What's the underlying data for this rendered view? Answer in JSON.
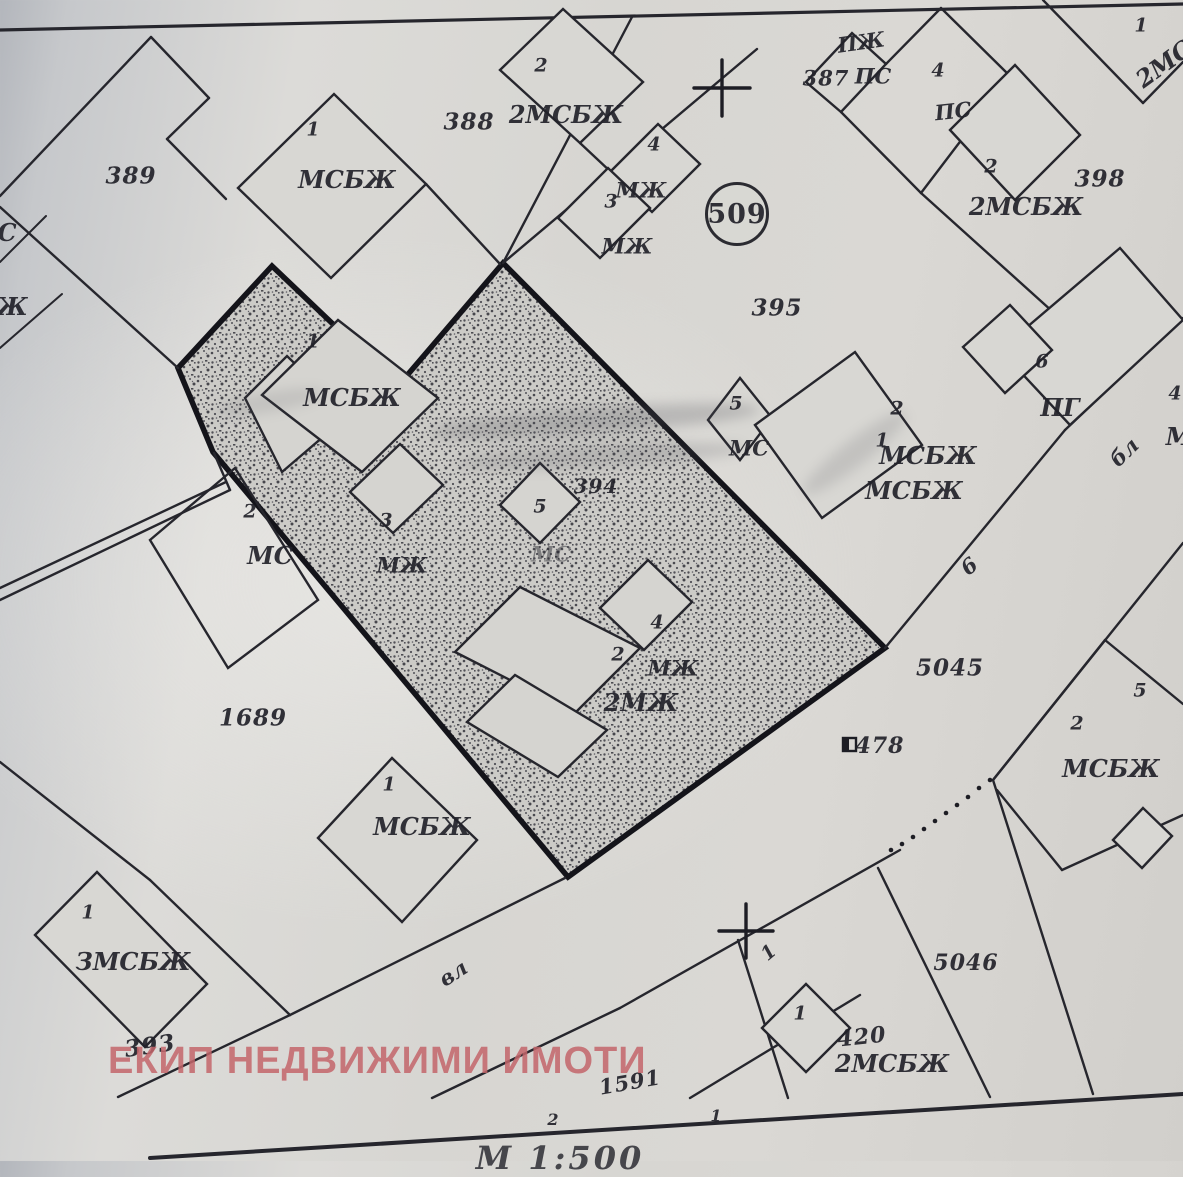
{
  "watermark": {
    "text": "ЕКИП НЕДВИЖИМИ ИМОТИ",
    "color": "#c4666b"
  },
  "colors": {
    "paper": "#d7d6d2",
    "ink": "#26262d",
    "plot_border": "#14141a",
    "watermark_red": "#c4666b"
  },
  "map": {
    "plot_circle_label": "509",
    "scale_note": "М 1:500",
    "labels": [
      {
        "t": "389",
        "x": 131,
        "y": 176,
        "c": "parcel"
      },
      {
        "t": "388",
        "x": 469,
        "y": 122,
        "c": "parcel"
      },
      {
        "t": "387",
        "x": 826,
        "y": 78,
        "c": "parcel",
        "s": 21
      },
      {
        "t": "398",
        "x": 1100,
        "y": 179,
        "c": "parcel"
      },
      {
        "t": "395",
        "x": 777,
        "y": 308,
        "c": "parcel"
      },
      {
        "t": "394",
        "x": 596,
        "y": 486,
        "c": "parcel",
        "s": 20
      },
      {
        "t": "1689",
        "x": 253,
        "y": 718,
        "c": "parcel"
      },
      {
        "t": "393",
        "x": 150,
        "y": 1046,
        "c": "parcel",
        "r": -8
      },
      {
        "t": "5045",
        "x": 950,
        "y": 668,
        "c": "parcel"
      },
      {
        "t": "5046",
        "x": 966,
        "y": 963,
        "c": "parcel",
        "s": 22
      },
      {
        "t": "420",
        "x": 862,
        "y": 1037,
        "c": "parcel",
        "r": -6,
        "s": 22
      },
      {
        "t": "1591",
        "x": 630,
        "y": 1082,
        "c": "parcel",
        "r": -10,
        "s": 21
      },
      {
        "t": "478",
        "x": 880,
        "y": 746,
        "c": "parcel",
        "s": 22
      },
      {
        "t": "МСБЖ",
        "x": 347,
        "y": 180,
        "c": "type"
      },
      {
        "t": "2МСБЖ",
        "x": 566,
        "y": 115,
        "c": "type"
      },
      {
        "t": "МЖ",
        "x": 641,
        "y": 190,
        "c": "type",
        "s": 21
      },
      {
        "t": "МЖ",
        "x": 627,
        "y": 246,
        "c": "type",
        "s": 21
      },
      {
        "t": "ПЖ",
        "x": 861,
        "y": 42,
        "c": "type",
        "s": 21,
        "r": -8
      },
      {
        "t": "ПС",
        "x": 873,
        "y": 76,
        "c": "type",
        "s": 21
      },
      {
        "t": "ПС",
        "x": 953,
        "y": 111,
        "c": "type",
        "s": 21,
        "r": -6
      },
      {
        "t": "2МСБЖ",
        "x": 1026,
        "y": 207,
        "c": "type"
      },
      {
        "t": "2МС",
        "x": 1164,
        "y": 64,
        "c": "type",
        "r": -36
      },
      {
        "t": "МС",
        "x": 749,
        "y": 448,
        "c": "type",
        "s": 21
      },
      {
        "t": "МСБЖ",
        "x": 928,
        "y": 456,
        "c": "type"
      },
      {
        "t": "МСБЖ",
        "x": 914,
        "y": 491,
        "c": "type"
      },
      {
        "t": "ПГ",
        "x": 1060,
        "y": 408,
        "c": "type"
      },
      {
        "t": "МСБЖ",
        "x": 352,
        "y": 398,
        "c": "type"
      },
      {
        "t": "МС",
        "x": 270,
        "y": 556,
        "c": "type"
      },
      {
        "t": "МЖ",
        "x": 402,
        "y": 565,
        "c": "type",
        "s": 21
      },
      {
        "t": "МС",
        "x": 551,
        "y": 554,
        "c": "type",
        "s": 21,
        "f": 1
      },
      {
        "t": "МЖ",
        "x": 673,
        "y": 668,
        "c": "type",
        "s": 21
      },
      {
        "t": "2МЖ",
        "x": 641,
        "y": 703,
        "c": "type"
      },
      {
        "t": "МСБЖ",
        "x": 1111,
        "y": 769,
        "c": "type"
      },
      {
        "t": "МСБЖ",
        "x": 422,
        "y": 827,
        "c": "type"
      },
      {
        "t": "ЗМСБЖ",
        "x": 133,
        "y": 962,
        "c": "type"
      },
      {
        "t": "2МСБЖ",
        "x": 892,
        "y": 1064,
        "c": "type"
      },
      {
        "t": "С",
        "x": 7,
        "y": 233,
        "c": "type"
      },
      {
        "t": "Ж",
        "x": 12,
        "y": 307,
        "c": "type"
      },
      {
        "t": "М",
        "x": 1179,
        "y": 437,
        "c": "type"
      },
      {
        "t": "1",
        "x": 313,
        "y": 130,
        "c": "num"
      },
      {
        "t": "2",
        "x": 541,
        "y": 66,
        "c": "num"
      },
      {
        "t": "4",
        "x": 654,
        "y": 145,
        "c": "num"
      },
      {
        "t": "3",
        "x": 611,
        "y": 202,
        "c": "num"
      },
      {
        "t": "4",
        "x": 938,
        "y": 71,
        "c": "num"
      },
      {
        "t": "2",
        "x": 991,
        "y": 167,
        "c": "num"
      },
      {
        "t": "1",
        "x": 1141,
        "y": 26,
        "c": "num"
      },
      {
        "t": "5",
        "x": 736,
        "y": 404,
        "c": "num"
      },
      {
        "t": "2",
        "x": 897,
        "y": 409,
        "c": "num"
      },
      {
        "t": "1",
        "x": 882,
        "y": 441,
        "c": "num"
      },
      {
        "t": "6",
        "x": 1042,
        "y": 362,
        "c": "num"
      },
      {
        "t": "4",
        "x": 1175,
        "y": 394,
        "c": "num"
      },
      {
        "t": "1",
        "x": 313,
        "y": 342,
        "c": "num"
      },
      {
        "t": "2",
        "x": 250,
        "y": 512,
        "c": "num"
      },
      {
        "t": "3",
        "x": 386,
        "y": 521,
        "c": "num"
      },
      {
        "t": "5",
        "x": 540,
        "y": 507,
        "c": "num"
      },
      {
        "t": "4",
        "x": 657,
        "y": 623,
        "c": "num"
      },
      {
        "t": "2",
        "x": 618,
        "y": 655,
        "c": "num"
      },
      {
        "t": "2",
        "x": 1077,
        "y": 724,
        "c": "num"
      },
      {
        "t": "5",
        "x": 1140,
        "y": 691,
        "c": "num"
      },
      {
        "t": "1",
        "x": 389,
        "y": 785,
        "c": "num"
      },
      {
        "t": "1",
        "x": 88,
        "y": 913,
        "c": "num"
      },
      {
        "t": "1",
        "x": 800,
        "y": 1014,
        "c": "num"
      },
      {
        "t": "2",
        "x": 553,
        "y": 1120,
        "c": "num",
        "s": 16
      },
      {
        "t": "1",
        "x": 716,
        "y": 1116,
        "c": "num",
        "s": 16
      },
      {
        "t": "вл",
        "x": 453,
        "y": 973,
        "c": "road",
        "r": -33
      },
      {
        "t": "бл",
        "x": 1124,
        "y": 452,
        "c": "road",
        "r": -44
      },
      {
        "t": "6",
        "x": 969,
        "y": 566,
        "c": "road",
        "r": -40
      },
      {
        "t": "1",
        "x": 769,
        "y": 953,
        "c": "road",
        "r": -40,
        "s": 19
      },
      {
        "t": "509",
        "x": 737,
        "y": 214,
        "c": "circle"
      },
      {
        "t": "М 1:500",
        "x": 560,
        "y": 1158,
        "c": "scale"
      }
    ]
  }
}
